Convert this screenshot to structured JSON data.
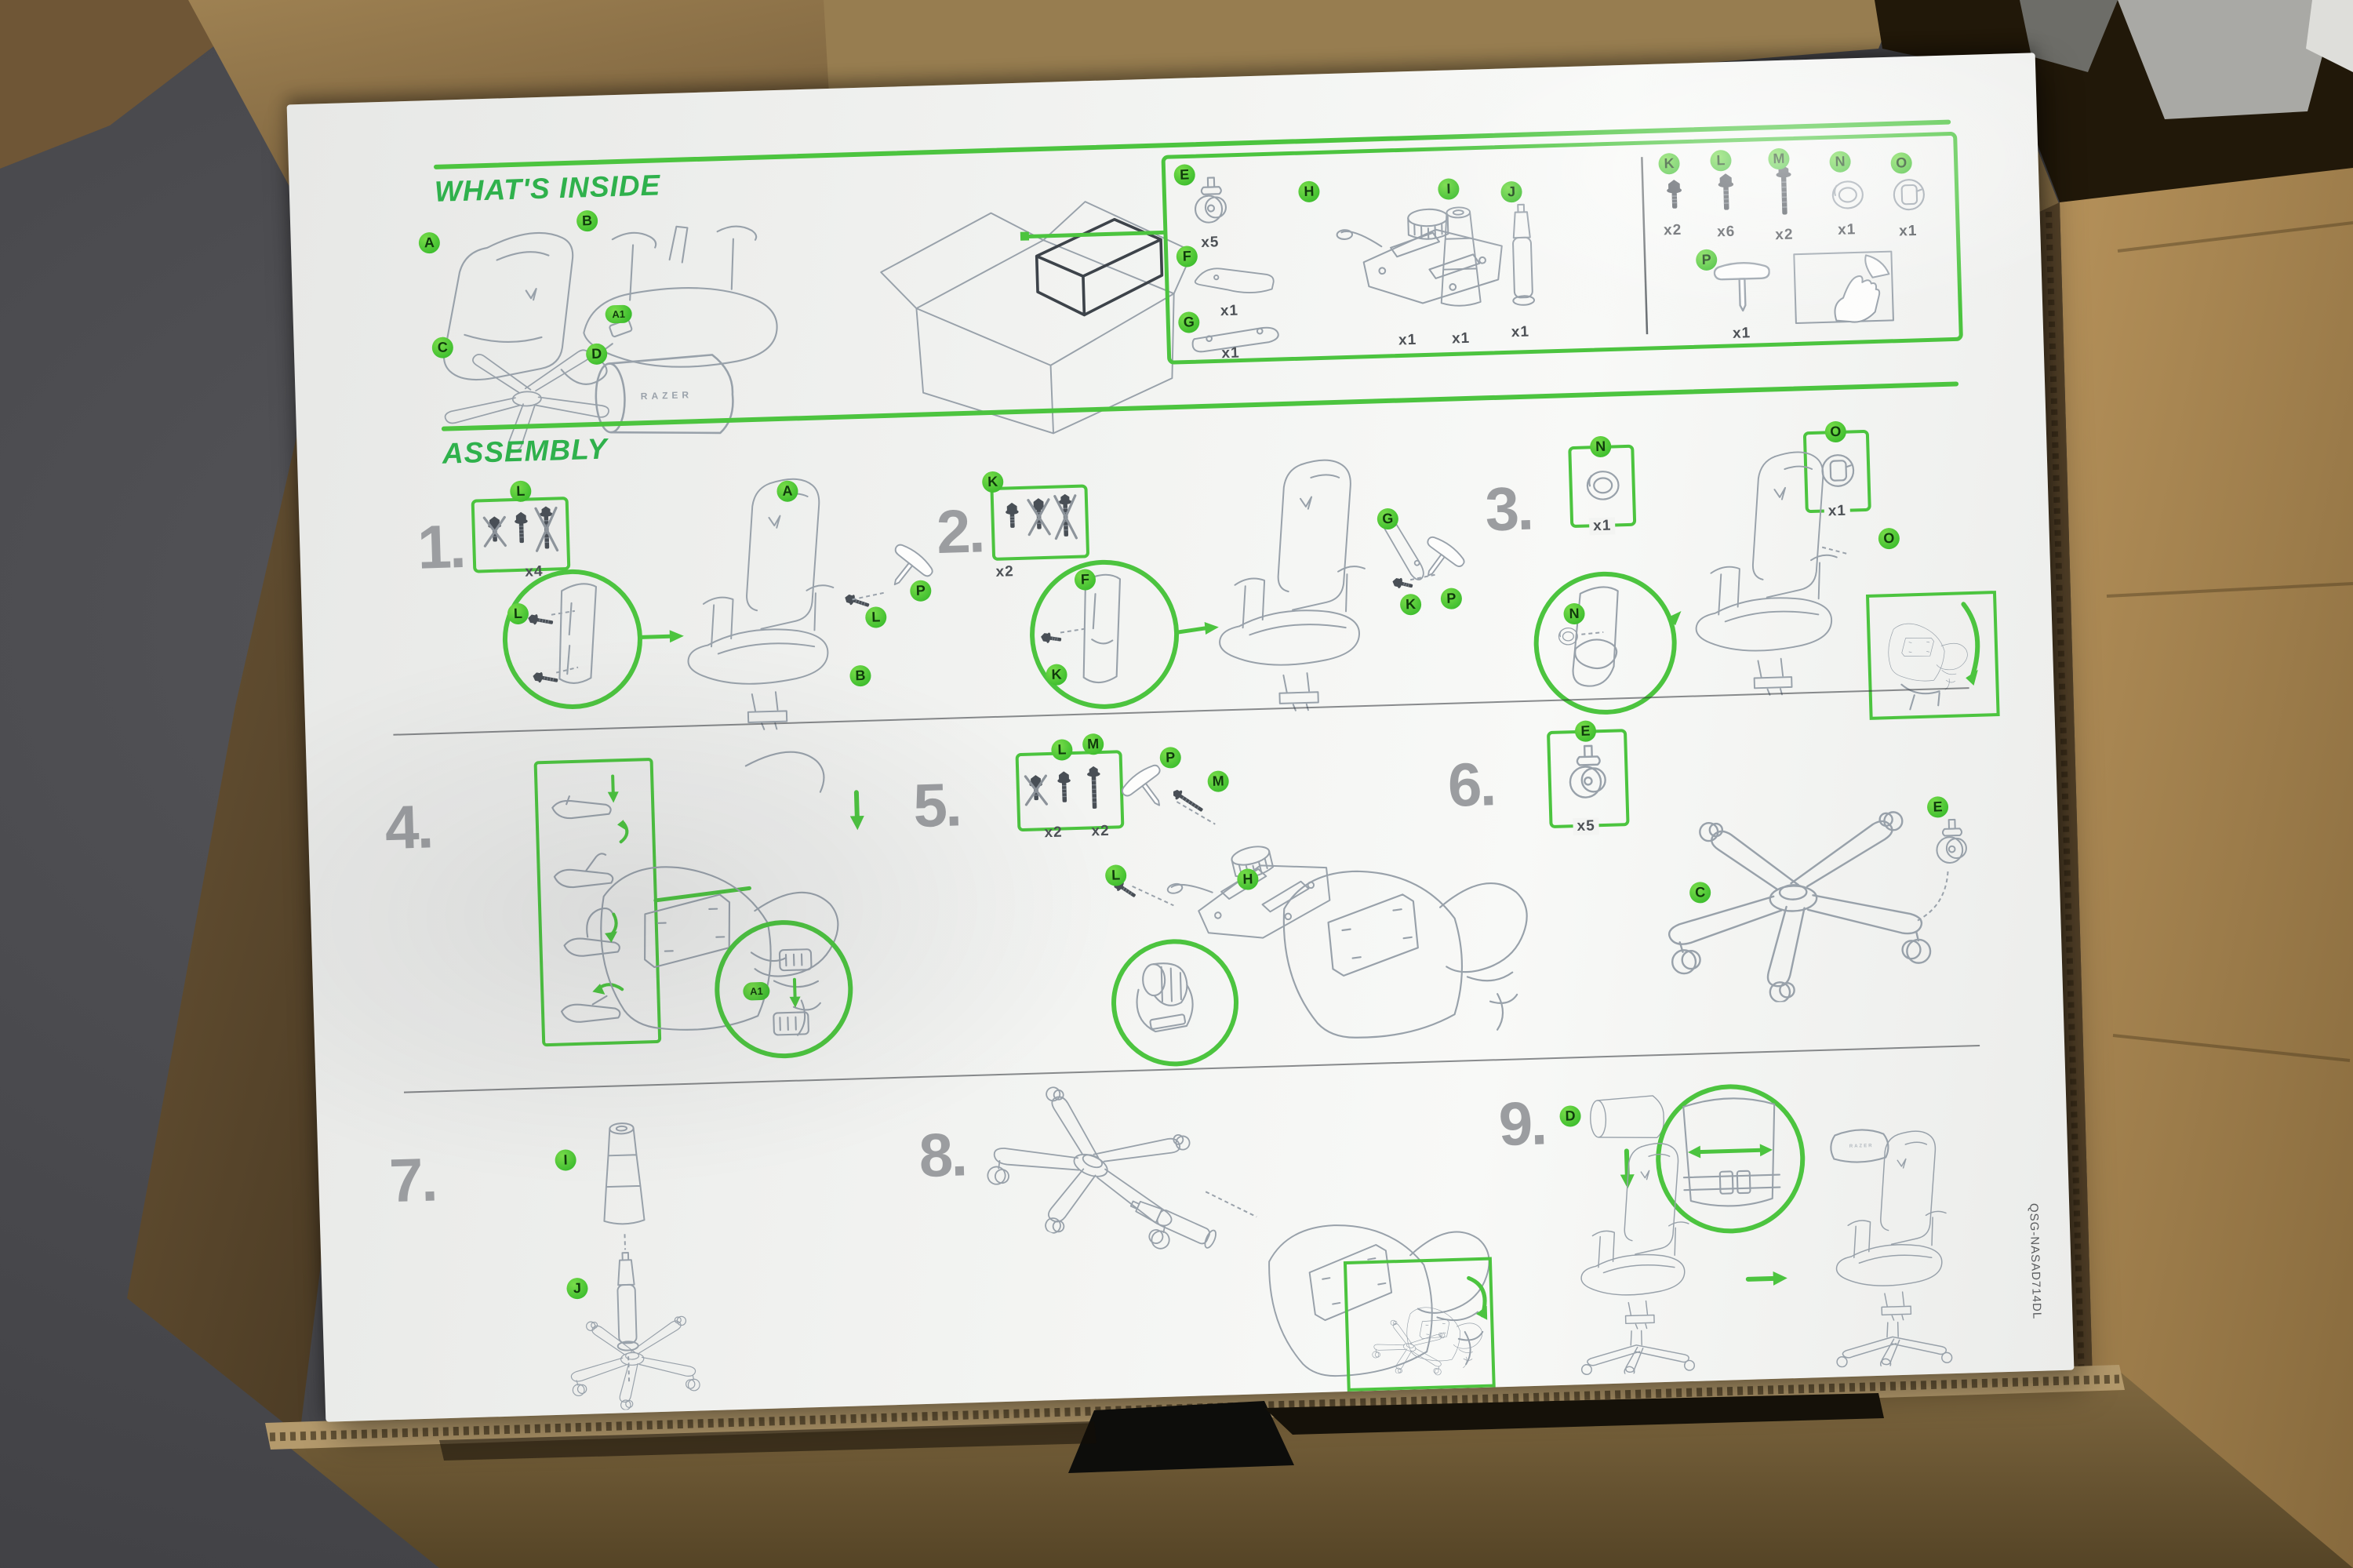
{
  "sections": {
    "whats_inside": "WHAT'S INSIDE",
    "assembly": "ASSEMBLY"
  },
  "parts": {
    "A": {
      "label": "A"
    },
    "A1": {
      "label": "A1"
    },
    "B": {
      "label": "B"
    },
    "C": {
      "label": "C"
    },
    "D": {
      "label": "D",
      "print": "RAZER"
    },
    "E": {
      "label": "E",
      "qty": "x5"
    },
    "F": {
      "label": "F",
      "qty": "x1"
    },
    "G": {
      "label": "G",
      "qty": "x1"
    },
    "H": {
      "label": "H",
      "qty": "x1"
    },
    "I": {
      "label": "I",
      "qty": "x1"
    },
    "J": {
      "label": "J",
      "qty": "x1"
    },
    "K": {
      "label": "K",
      "qty": "x2"
    },
    "L": {
      "label": "L",
      "qty": "x6"
    },
    "M": {
      "label": "M",
      "qty": "x2"
    },
    "N": {
      "label": "N",
      "qty": "x1"
    },
    "O": {
      "label": "O",
      "qty": "x1"
    },
    "P": {
      "label": "P",
      "qty": "x1"
    }
  },
  "steps": [
    {
      "num": "1.",
      "qty": "x4"
    },
    {
      "num": "2.",
      "qty": "x2"
    },
    {
      "num": "3.",
      "qty_n": "x1",
      "qty_o": "x1"
    },
    {
      "num": "4."
    },
    {
      "num": "5.",
      "qty_l": "x2",
      "qty_m": "x2"
    },
    {
      "num": "6.",
      "qty_e": "x5"
    },
    {
      "num": "7."
    },
    {
      "num": "8."
    },
    {
      "num": "9."
    }
  ],
  "footer_code": "QSG-NASAD714DL",
  "icons": {
    "zoom-detail-circle": "green magnifier circle",
    "insert-arrow": "green straight arrow",
    "flip-arrow": "green curved arrow",
    "slide-arrow": "green double-headed arrow",
    "peel-hand": "hand peeling protective film",
    "cross-out": "grey X over wrong fastener"
  },
  "colors": {
    "accent_green": "#4cc43f",
    "title_green": "#2fb14c",
    "badge_green": "#3dbd2e",
    "sketch_grey": "#98a1aa",
    "number_grey": "#9b9da0",
    "poster_white": "#f1f2f0",
    "cardboard": "#9a7b4e",
    "cardboard_dark": "#5f4c2e",
    "carpet_grey": "#4b4b4f",
    "foam_black": "#0d0d0b"
  }
}
